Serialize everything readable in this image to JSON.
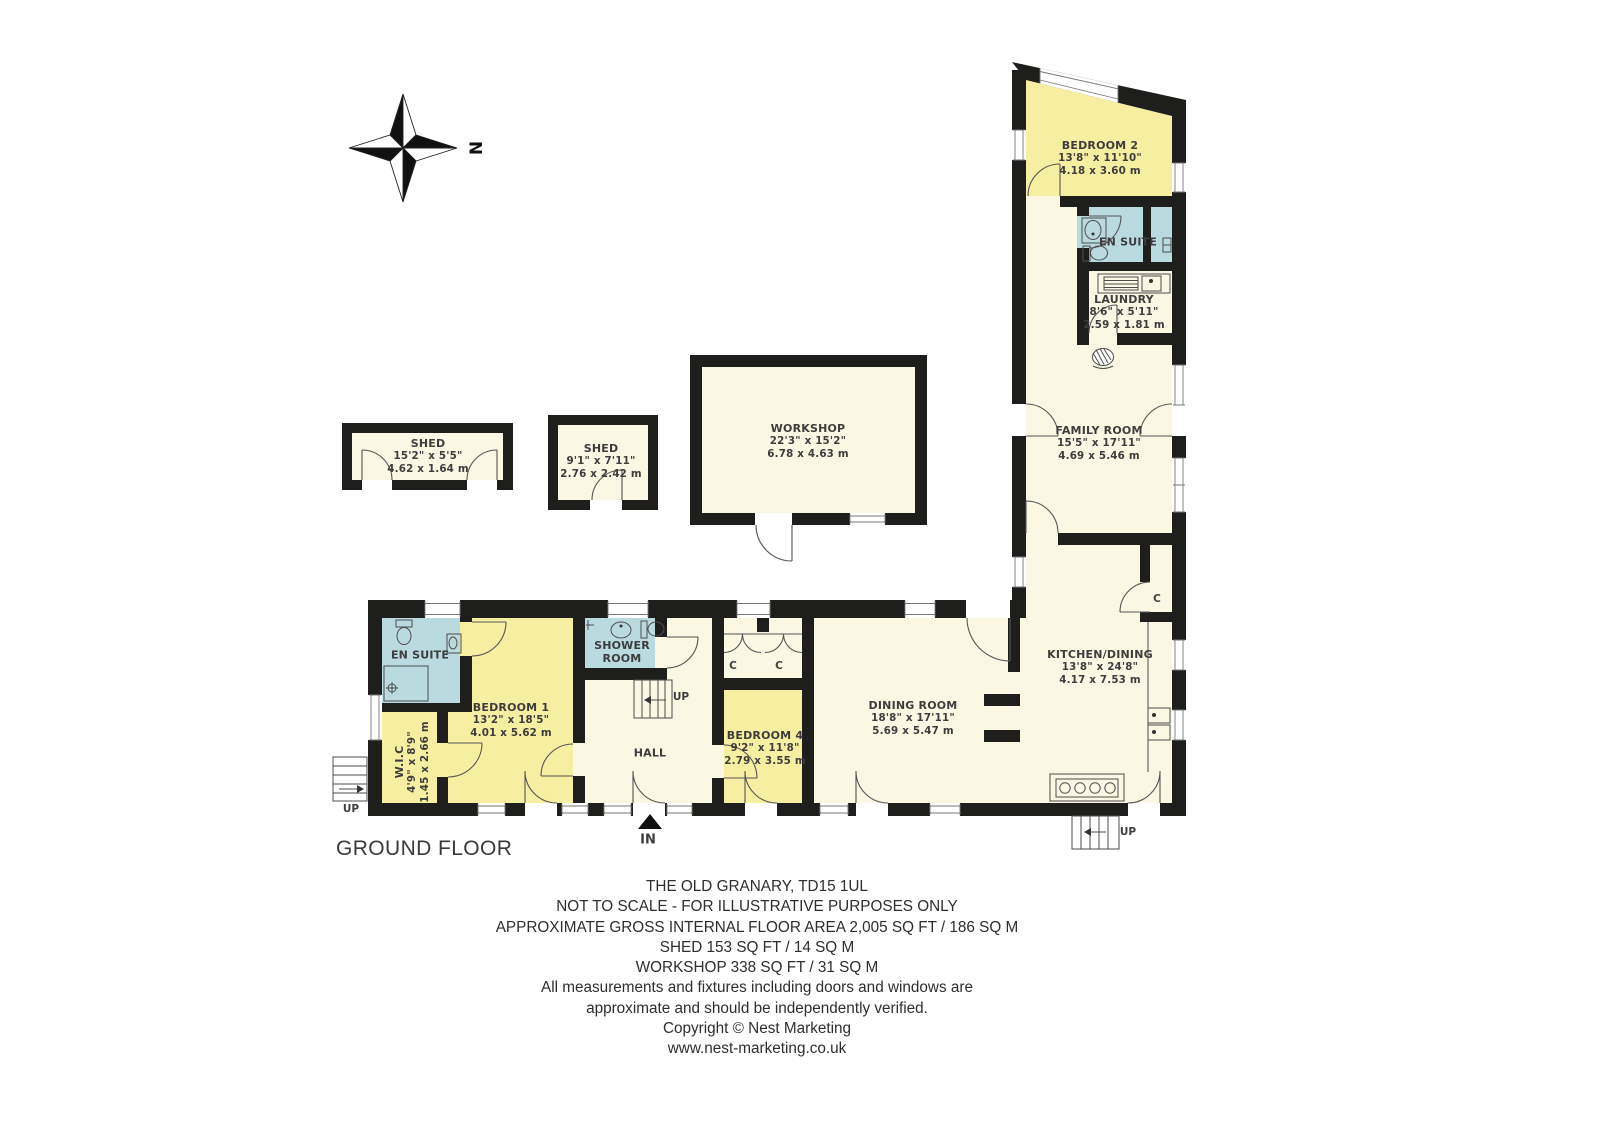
{
  "floor_label": "GROUND FLOOR",
  "compass": {
    "north": "N"
  },
  "markers": {
    "up": "UP",
    "in": "IN",
    "closet": "C"
  },
  "rooms": [
    {
      "id": "bedroom-2",
      "name": "BEDROOM 2",
      "ft": "13'8\" x 11'10\"",
      "m": "4.18 x 3.60 m"
    },
    {
      "id": "en-suite-2",
      "name": "EN SUITE"
    },
    {
      "id": "laundry",
      "name": "LAUNDRY",
      "ft": "8'6\" x 5'11\"",
      "m": "2.59 x 1.81 m"
    },
    {
      "id": "family-room",
      "name": "FAMILY ROOM",
      "ft": "15'5\" x 17'11\"",
      "m": "4.69 x 5.46 m"
    },
    {
      "id": "kitchen-dining",
      "name": "KITCHEN/DINING",
      "ft": "13'8\" x 24'8\"",
      "m": "4.17 x 7.53 m"
    },
    {
      "id": "dining-room",
      "name": "DINING ROOM",
      "ft": "18'8\" x 17'11\"",
      "m": "5.69 x 5.47 m"
    },
    {
      "id": "bedroom-4",
      "name": "BEDROOM 4",
      "ft": "9'2\" x 11'8\"",
      "m": "2.79 x 3.55 m"
    },
    {
      "id": "hall",
      "name": "HALL"
    },
    {
      "id": "shower-room",
      "name": "SHOWER",
      "name2": "ROOM"
    },
    {
      "id": "bedroom-1",
      "name": "BEDROOM 1",
      "ft": "13'2\" x 18'5\"",
      "m": "4.01 x 5.62 m"
    },
    {
      "id": "en-suite-1",
      "name": "EN SUITE"
    },
    {
      "id": "wic",
      "name": "W.I.C",
      "ft": "4'9\" x 8'9\"",
      "m": "1.45 x 2.66 m"
    },
    {
      "id": "workshop",
      "name": "WORKSHOP",
      "ft": "22'3\" x 15'2\"",
      "m": "6.78 x 4.63 m"
    },
    {
      "id": "shed-large",
      "name": "SHED",
      "ft": "15'2\" x 5'5\"",
      "m": "4.62 x 1.64 m"
    },
    {
      "id": "shed-small",
      "name": "SHED",
      "ft": "9'1\" x 7'11\"",
      "m": "2.76 x 2.42 m"
    }
  ],
  "footer": {
    "lines": [
      "THE OLD GRANARY, TD15 1UL",
      "NOT TO SCALE - FOR ILLUSTRATIVE PURPOSES ONLY",
      "APPROXIMATE GROSS INTERNAL FLOOR AREA 2,005 SQ FT / 186 SQ M",
      "SHED 153 SQ FT / 14 SQ M",
      "WORKSHOP 338 SQ FT / 31 SQ M",
      "All measurements and fixtures including doors and windows are",
      "approximate and should be independently verified.",
      "Copyright © Nest Marketing",
      "www.nest-marketing.co.uk"
    ]
  },
  "colors": {
    "room_yellow": "#F6EFA1",
    "room_cream": "#FAF7E3",
    "room_teal": "#B9DBE0",
    "wall": "#1E1E1C"
  }
}
